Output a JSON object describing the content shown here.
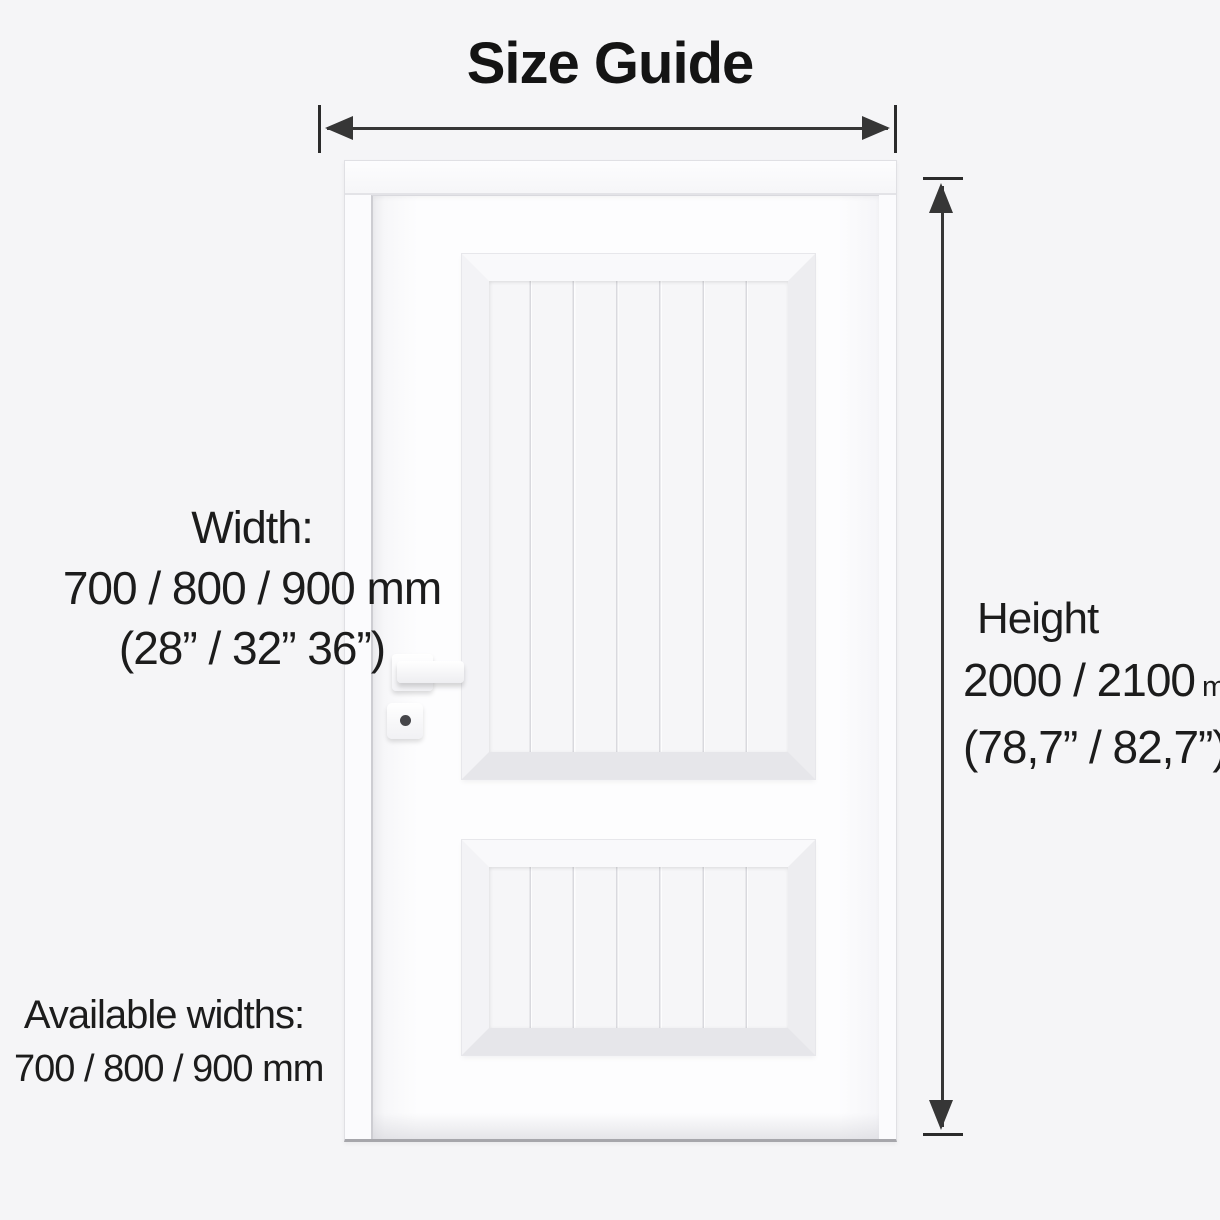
{
  "title": "Size Guide",
  "width_label": {
    "heading": "Width:",
    "metric": "700 / 800 / 900 mm",
    "imperial": "(28” / 32” 36”)"
  },
  "height_label": {
    "heading": "Height",
    "metric": "2000 / 2100",
    "unit": "mn",
    "imperial": "(78,7” / 82,7”)"
  },
  "available_widths": {
    "heading": "Available widths:",
    "metric": "700 / 800 / 900 mm"
  },
  "door": {
    "panel_count": 2,
    "color": "#fdfdfe"
  },
  "colors": {
    "background": "#f5f5f7",
    "ink": "#1c1c1c",
    "arrow": "#363636"
  }
}
